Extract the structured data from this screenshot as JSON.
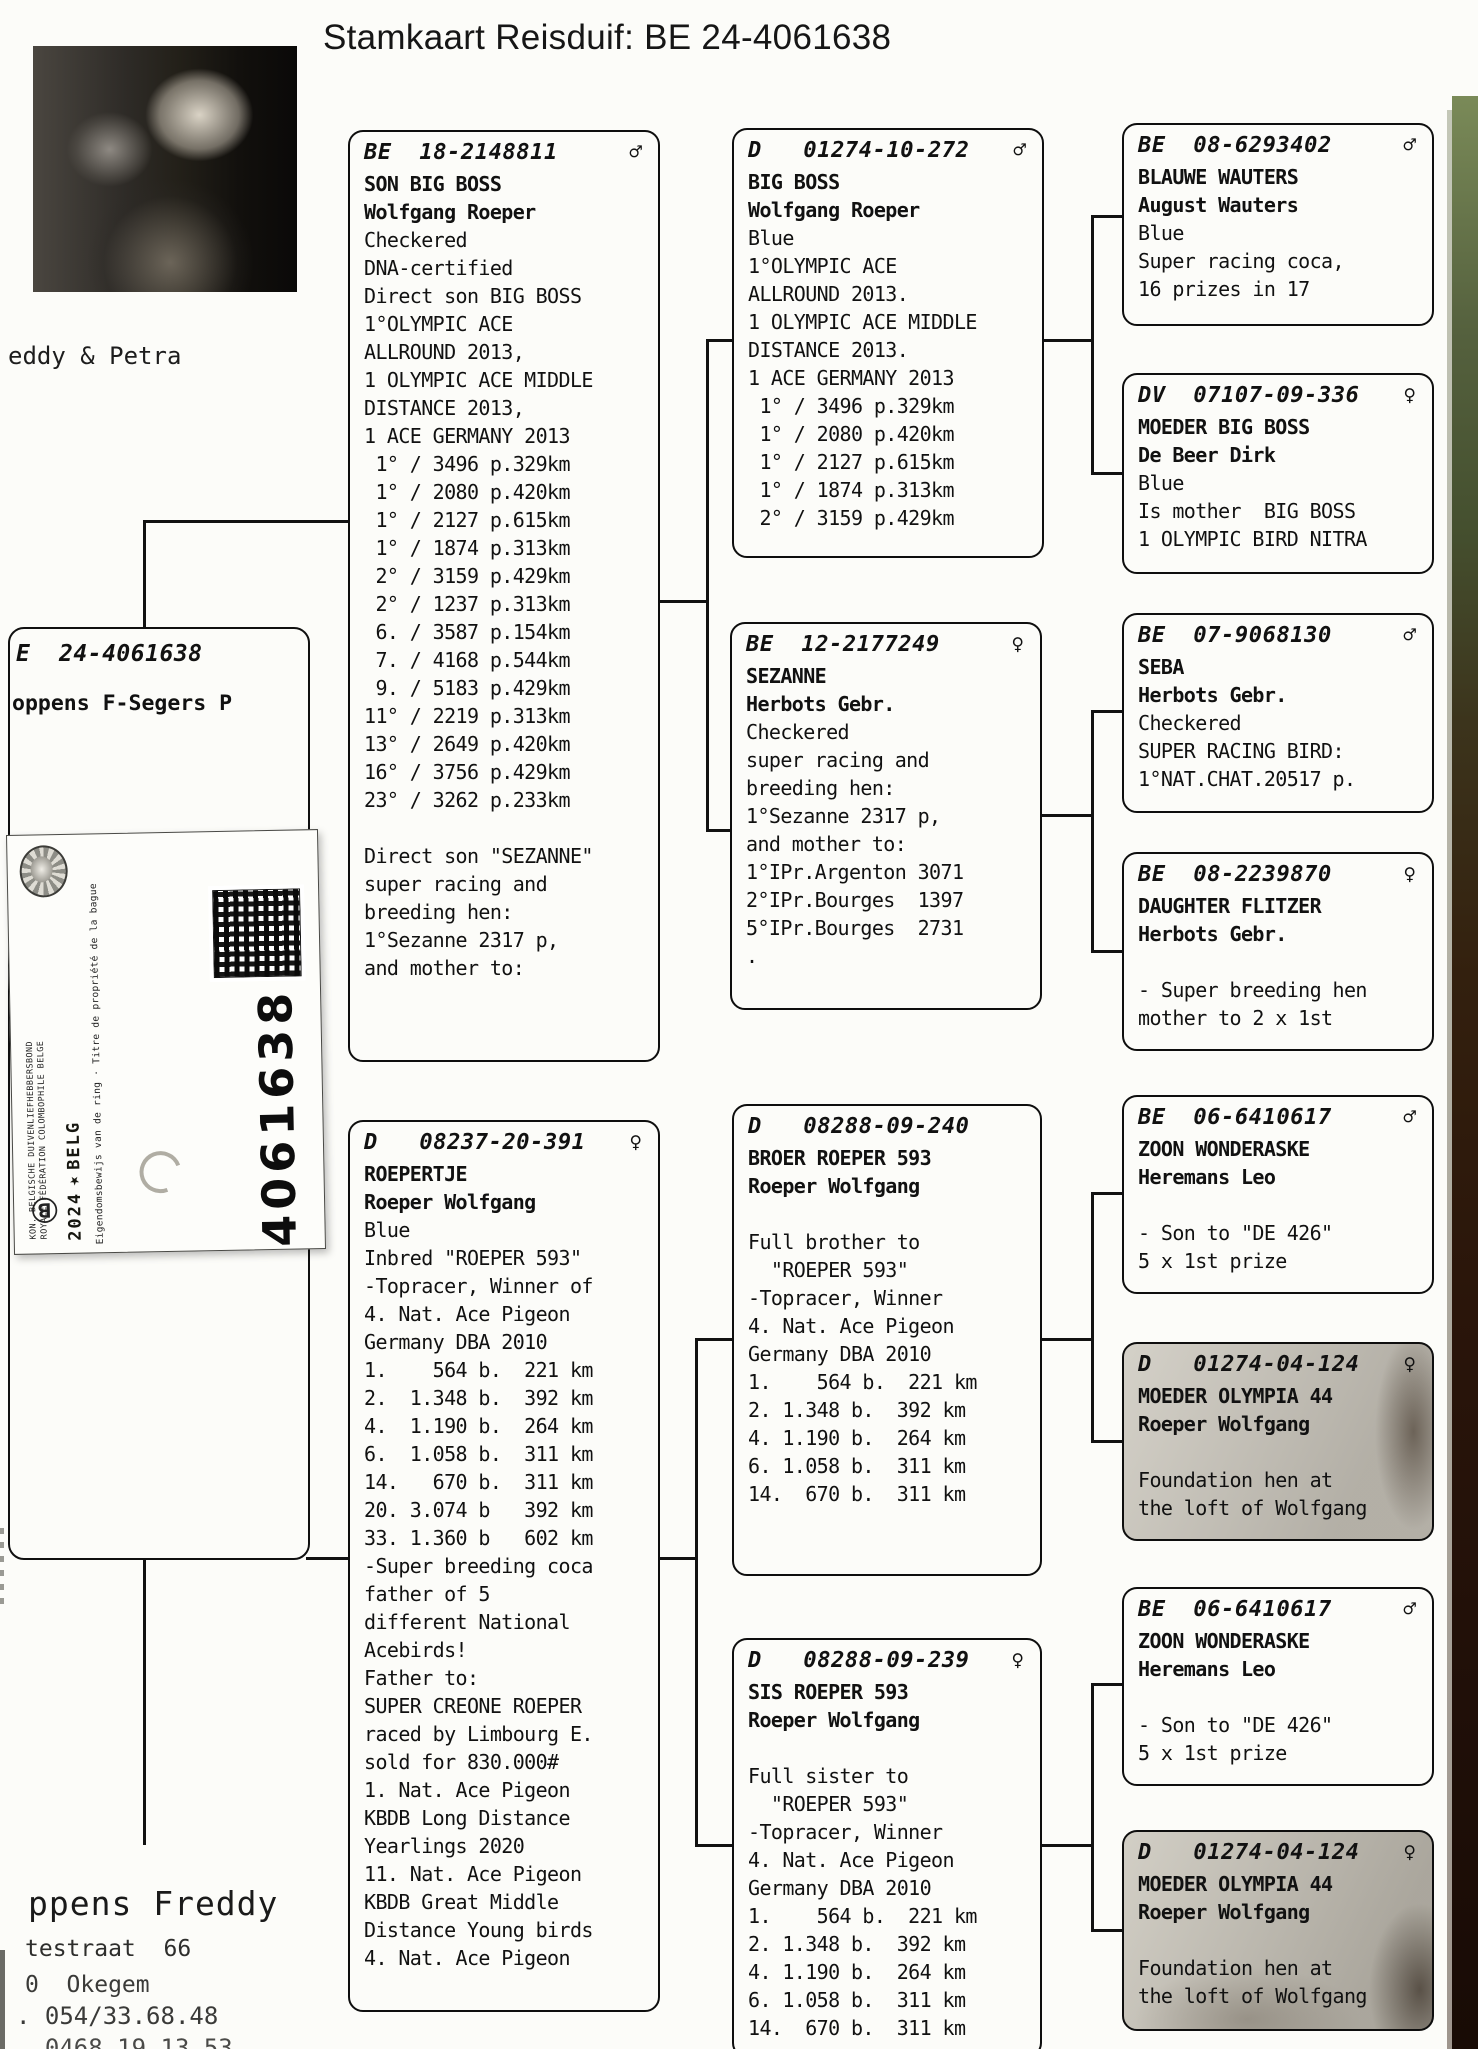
{
  "title": "Stamkaart Reisduif: BE  24-4061638",
  "photo": {
    "caption": "eddy & Petra"
  },
  "subject_box": {
    "ring": "E  24-4061638",
    "owner": "oppens F-Segers P"
  },
  "ring_sticker": {
    "federation_nl": "KON. BELGISCHE DUIVENLIEFHEBBERSBOND",
    "federation_fr": "ROYALE FÉDÉRATION COLOMBOPHILE BELGE",
    "year": "2024",
    "logo_glyph": "★",
    "country": "BELG",
    "ownership_text": "Eigendomsbewijs van de ring · Titre de propriété de la bague",
    "ring_number": "4061638",
    "b_mark": "Ⓑ"
  },
  "owner_block": {
    "name": "ppens Freddy",
    "street": "testraat  66",
    "city": "0  Okegem",
    "phone1": ". 054/33.68.48",
    "phone2": ". 0468 19.13.53"
  },
  "colors": {
    "ink": "#111111",
    "scan_edge_green": "#5b6a43",
    "scan_edge_brown": "#2a140a"
  },
  "pedigree": {
    "boxes": [
      {
        "id": "sire",
        "ring": "BE  18-2148811",
        "sex": "♂",
        "lines": [
          {
            "t": "SON BIG BOSS",
            "b": 1
          },
          {
            "t": "Wolfgang Roeper",
            "b": 1
          },
          {
            "t": "Checkered"
          },
          {
            "t": "DNA-certified"
          },
          {
            "t": "Direct son BIG BOSS"
          },
          {
            "t": "1°OLYMPIC ACE"
          },
          {
            "t": "ALLROUND 2013,"
          },
          {
            "t": "1 OLYMPIC ACE MIDDLE"
          },
          {
            "t": "DISTANCE 2013,"
          },
          {
            "t": "1 ACE GERMANY 2013"
          },
          {
            "t": " 1° / 3496 p.329km"
          },
          {
            "t": " 1° / 2080 p.420km"
          },
          {
            "t": " 1° / 2127 p.615km"
          },
          {
            "t": " 1° / 1874 p.313km"
          },
          {
            "t": " 2° / 3159 p.429km"
          },
          {
            "t": " 2° / 1237 p.313km"
          },
          {
            "t": " 6. / 3587 p.154km"
          },
          {
            "t": " 7. / 4168 p.544km"
          },
          {
            "t": " 9. / 5183 p.429km"
          },
          {
            "t": "11° / 2219 p.313km"
          },
          {
            "t": "13° / 2649 p.420km"
          },
          {
            "t": "16° / 3756 p.429km"
          },
          {
            "t": "23° / 3262 p.233km"
          },
          {
            "t": ""
          },
          {
            "t": "Direct son \"SEZANNE\""
          },
          {
            "t": "super racing and"
          },
          {
            "t": "breeding hen:"
          },
          {
            "t": "1°Sezanne 2317 p,"
          },
          {
            "t": "and mother to:"
          }
        ]
      },
      {
        "id": "dam",
        "ring": "D   08237-20-391",
        "sex": "♀",
        "lines": [
          {
            "t": "ROEPERTJE",
            "b": 1
          },
          {
            "t": "Roeper Wolfgang",
            "b": 1
          },
          {
            "t": "Blue"
          },
          {
            "t": "Inbred \"ROEPER 593\""
          },
          {
            "t": "-Topracer, Winner of"
          },
          {
            "t": "4. Nat. Ace Pigeon"
          },
          {
            "t": "Germany DBA 2010"
          },
          {
            "t": "1.    564 b.  221 km"
          },
          {
            "t": "2.  1.348 b.  392 km"
          },
          {
            "t": "4.  1.190 b.  264 km"
          },
          {
            "t": "6.  1.058 b.  311 km"
          },
          {
            "t": "14.   670 b.  311 km"
          },
          {
            "t": "20. 3.074 b   392 km"
          },
          {
            "t": "33. 1.360 b   602 km"
          },
          {
            "t": "-Super breeding coca"
          },
          {
            "t": "father of 5"
          },
          {
            "t": "different National"
          },
          {
            "t": "Acebirds!"
          },
          {
            "t": "Father to:"
          },
          {
            "t": "SUPER CREONE ROEPER"
          },
          {
            "t": "raced by Limbourg E."
          },
          {
            "t": "sold for 830.000#"
          },
          {
            "t": "1. Nat. Ace Pigeon"
          },
          {
            "t": "KBDB Long Distance"
          },
          {
            "t": "Yearlings 2020"
          },
          {
            "t": "11. Nat. Ace Pigeon"
          },
          {
            "t": "KBDB Great Middle"
          },
          {
            "t": "Distance Young birds"
          },
          {
            "t": "4. Nat. Ace Pigeon"
          }
        ]
      },
      {
        "id": "ss",
        "ring": "D   01274-10-272",
        "sex": "♂",
        "lines": [
          {
            "t": "BIG BOSS",
            "b": 1
          },
          {
            "t": "Wolfgang Roeper",
            "b": 1
          },
          {
            "t": "Blue"
          },
          {
            "t": "1°OLYMPIC ACE"
          },
          {
            "t": "ALLROUND 2013."
          },
          {
            "t": "1 OLYMPIC ACE MIDDLE"
          },
          {
            "t": "DISTANCE 2013."
          },
          {
            "t": "1 ACE GERMANY 2013"
          },
          {
            "t": " 1° / 3496 p.329km"
          },
          {
            "t": " 1° / 2080 p.420km"
          },
          {
            "t": " 1° / 2127 p.615km"
          },
          {
            "t": " 1° / 1874 p.313km"
          },
          {
            "t": " 2° / 3159 p.429km"
          }
        ]
      },
      {
        "id": "sd",
        "ring": "BE  12-2177249",
        "sex": "♀",
        "lines": [
          {
            "t": "SEZANNE",
            "b": 1
          },
          {
            "t": "Herbots Gebr.",
            "b": 1
          },
          {
            "t": "Checkered"
          },
          {
            "t": "super racing and"
          },
          {
            "t": "breeding hen:"
          },
          {
            "t": "1°Sezanne 2317 p,"
          },
          {
            "t": "and mother to:"
          },
          {
            "t": "1°IPr.Argenton 3071"
          },
          {
            "t": "2°IPr.Bourges  1397"
          },
          {
            "t": "5°IPr.Bourges  2731"
          },
          {
            "t": "."
          }
        ]
      },
      {
        "id": "ds",
        "ring": "D   08288-09-240",
        "sex": "",
        "lines": [
          {
            "t": "BROER ROEPER 593",
            "b": 1
          },
          {
            "t": "Roeper Wolfgang",
            "b": 1
          },
          {
            "t": ""
          },
          {
            "t": "Full brother to"
          },
          {
            "t": "  \"ROEPER 593\""
          },
          {
            "t": "-Topracer, Winner"
          },
          {
            "t": "4. Nat. Ace Pigeon"
          },
          {
            "t": "Germany DBA 2010"
          },
          {
            "t": "1.    564 b.  221 km"
          },
          {
            "t": "2. 1.348 b.  392 km"
          },
          {
            "t": "4. 1.190 b.  264 km"
          },
          {
            "t": "6. 1.058 b.  311 km"
          },
          {
            "t": "14.  670 b.  311 km"
          }
        ]
      },
      {
        "id": "dd",
        "ring": "D   08288-09-239",
        "sex": "♀",
        "lines": [
          {
            "t": "SIS ROEPER 593",
            "b": 1
          },
          {
            "t": "Roeper Wolfgang",
            "b": 1
          },
          {
            "t": ""
          },
          {
            "t": "Full sister to"
          },
          {
            "t": "  \"ROEPER 593\""
          },
          {
            "t": "-Topracer, Winner"
          },
          {
            "t": "4. Nat. Ace Pigeon"
          },
          {
            "t": "Germany DBA 2010"
          },
          {
            "t": "1.    564 b.  221 km"
          },
          {
            "t": "2. 1.348 b.  392 km"
          },
          {
            "t": "4. 1.190 b.  264 km"
          },
          {
            "t": "6. 1.058 b.  311 km"
          },
          {
            "t": "14.  670 b.  311 km"
          }
        ]
      },
      {
        "id": "ss-s",
        "ring": "BE  08-6293402",
        "sex": "♂",
        "lines": [
          {
            "t": "BLAUWE WAUTERS",
            "b": 1
          },
          {
            "t": "August Wauters",
            "b": 1
          },
          {
            "t": "Blue"
          },
          {
            "t": "Super racing coca,"
          },
          {
            "t": "16 prizes in 17"
          }
        ]
      },
      {
        "id": "ss-d",
        "ring": "DV  07107-09-336",
        "sex": "♀",
        "lines": [
          {
            "t": "MOEDER BIG BOSS",
            "b": 1
          },
          {
            "t": "De Beer Dirk",
            "b": 1
          },
          {
            "t": "Blue"
          },
          {
            "t": "Is mother  BIG BOSS"
          },
          {
            "t": "1 OLYMPIC BIRD NITRA"
          }
        ]
      },
      {
        "id": "sd-s",
        "ring": "BE  07-9068130",
        "sex": "♂",
        "lines": [
          {
            "t": "SEBA",
            "b": 1
          },
          {
            "t": "Herbots Gebr.",
            "b": 1
          },
          {
            "t": "Checkered"
          },
          {
            "t": "SUPER RACING BIRD:"
          },
          {
            "t": "1°NAT.CHAT.20517 p."
          }
        ]
      },
      {
        "id": "sd-d",
        "ring": "BE  08-2239870",
        "sex": "♀",
        "lines": [
          {
            "t": "DAUGHTER FLITZER",
            "b": 1
          },
          {
            "t": "Herbots Gebr.",
            "b": 1
          },
          {
            "t": ""
          },
          {
            "t": "- Super breeding hen"
          },
          {
            "t": "mother to 2 x 1st"
          }
        ]
      },
      {
        "id": "ds-s",
        "ring": "BE  06-6410617",
        "sex": "♂",
        "lines": [
          {
            "t": "ZOON WONDERASKE",
            "b": 1
          },
          {
            "t": "Heremans Leo",
            "b": 1
          },
          {
            "t": ""
          },
          {
            "t": "- Son to \"DE 426\""
          },
          {
            "t": "5 x 1st prize"
          }
        ]
      },
      {
        "id": "ds-d",
        "ring": "D   01274-04-124",
        "sex": "♀",
        "lines": [
          {
            "t": "MOEDER OLYMPIA 44",
            "b": 1
          },
          {
            "t": "Roeper Wolfgang",
            "b": 1
          },
          {
            "t": ""
          },
          {
            "t": "Foundation hen at"
          },
          {
            "t": "the loft of Wolfgang"
          }
        ]
      },
      {
        "id": "dd-s",
        "ring": "BE  06-6410617",
        "sex": "♂",
        "lines": [
          {
            "t": "ZOON WONDERASKE",
            "b": 1
          },
          {
            "t": "Heremans Leo",
            "b": 1
          },
          {
            "t": ""
          },
          {
            "t": "- Son to \"DE 426\""
          },
          {
            "t": "5 x 1st prize"
          }
        ]
      },
      {
        "id": "dd-d",
        "ring": "D   01274-04-124",
        "sex": "♀",
        "lines": [
          {
            "t": "MOEDER OLYMPIA 44",
            "b": 1
          },
          {
            "t": "Roeper Wolfgang",
            "b": 1
          },
          {
            "t": ""
          },
          {
            "t": "Foundation hen at"
          },
          {
            "t": "the loft of Wolfgang"
          }
        ]
      }
    ]
  }
}
